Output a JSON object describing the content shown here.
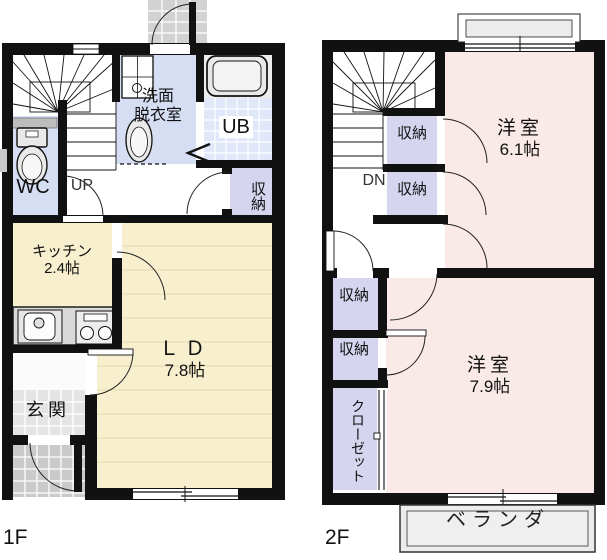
{
  "f1": {
    "floor_label": "1F",
    "entrance": "玄関",
    "kitchen": "キッチン",
    "kitchen_size": "2.4帖",
    "living_dining": "ＬＤ",
    "living_dining_size": "7.8帖",
    "wc": "WC",
    "washroom_line1": "洗面",
    "washroom_line2": "脱衣室",
    "unit_bath": "UB",
    "storage": "収納",
    "stairs_dir": "UP"
  },
  "f2": {
    "floor_label": "2F",
    "room1": "洋室",
    "room1_size": "6.1帖",
    "room2": "洋室",
    "room2_size": "7.9帖",
    "storage1": "収納",
    "storage2": "収納",
    "storage3": "収納",
    "storage4": "収納",
    "closet": "クローゼット",
    "stairs_dir": "DN",
    "veranda": "ベランダ"
  },
  "colors": {
    "wall": "#111111",
    "flooring_cream": "#f8efce",
    "flooring_stripe": "#eadfba",
    "western_room_pink": "#f9e9e7",
    "closet_purple": "#d5d5ef",
    "wet_area_blue": "#d6def4",
    "ub_tile_blue": "#dfe7f8",
    "entrance_tile_gray": "#e4e4e4",
    "porch_gray": "#cacaca",
    "veranda_gray": "#ececec"
  }
}
